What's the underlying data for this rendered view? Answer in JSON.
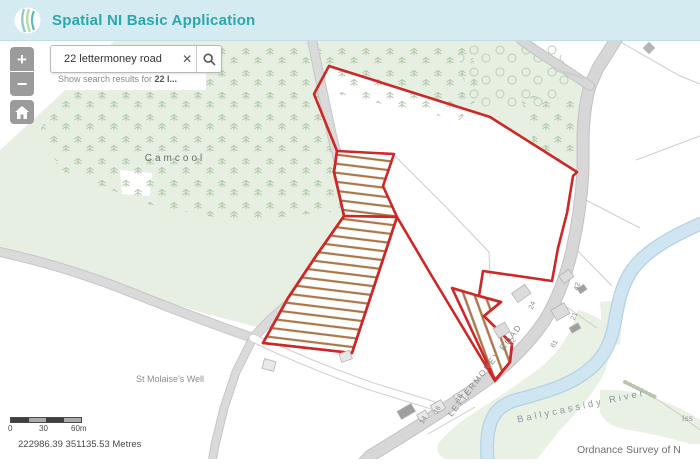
{
  "header": {
    "title": "Spatial NI Basic Application"
  },
  "controls": {
    "zoom_in_label": "+",
    "zoom_out_label": "−"
  },
  "search": {
    "value": "22 lettermoney road",
    "clear_icon": "✕",
    "hint_prefix": "Show search results for ",
    "hint_term": "22 l..."
  },
  "map": {
    "labels": {
      "townland": "Camcool",
      "well": "St Molaise's Well",
      "river": "Ballycassidy River",
      "road": "LETTERMONEY ROAD",
      "issues": "Iss"
    },
    "house_numbers": [
      {
        "label": "42"
      },
      {
        "label": "24"
      },
      {
        "label": "21"
      },
      {
        "label": "22"
      },
      {
        "label": "61"
      },
      {
        "label": "18"
      },
      {
        "label": "16"
      },
      {
        "label": "14"
      }
    ]
  },
  "scale_bar": {
    "ticks": [
      "0",
      "30",
      "60m"
    ]
  },
  "status": {
    "coordinates": "222986.39 351135.53 Metres"
  },
  "attribution": "Ordnance Survey of N",
  "colors": {
    "header_bg": "#d5ebf2",
    "title_teal": "#2ba7ad",
    "boundary_red": "#cf2626",
    "hatch_brown": "#ab7648",
    "river_blue": "#cfe5f1",
    "woodland_green": "#e6efe2",
    "road_gray": "#d8d8d8",
    "button_gray": "#9b9b9b"
  }
}
